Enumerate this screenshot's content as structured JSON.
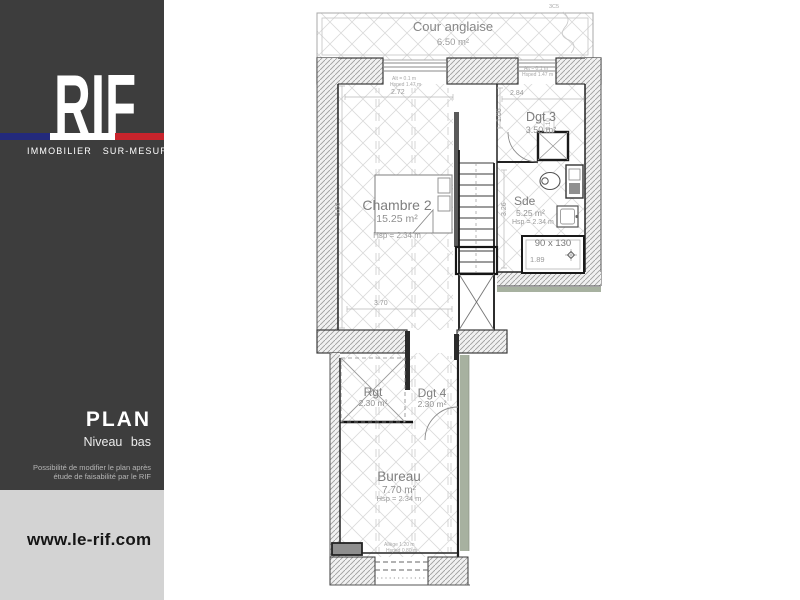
{
  "sidebar": {
    "logo": "RIF",
    "tagline": "IMMOBILIER SUR-MESURE",
    "plan_title": "PLAN",
    "plan_subtitle": "Niveau bas",
    "note_line1": "Possibilité de modifier le plan après",
    "note_line2": "étude de faisabilité par le RIF",
    "website": "www.le-rif.com",
    "colors": {
      "background": "#3d3d3d",
      "footer_bg": "#d3d3d3",
      "flag_blue": "#232a7c",
      "flag_white": "#ffffff",
      "flag_red": "#c8242c"
    }
  },
  "plan": {
    "rooms": {
      "cour": {
        "name": "Cour anglaise",
        "area": "6.50 m²"
      },
      "dgt3": {
        "name": "Dgt 3",
        "area": "3.50 m²"
      },
      "chambre2": {
        "name": "Chambre 2",
        "area": "15.25 m²",
        "height": "Hsp = 2.34 m"
      },
      "sde": {
        "name": "Sde",
        "area": "5.25 m²",
        "height": "Hsp = 2.34 m"
      },
      "rgt": {
        "name": "Rgt",
        "area": "2.30 m²"
      },
      "dgt4": {
        "name": "Dgt 4",
        "area": "2.30 m²"
      },
      "bureau": {
        "name": "Bureau",
        "area": "7.70 m²",
        "height": "Hsp = 2.34 m"
      }
    },
    "fixtures": {
      "shower_size": "90 x 130",
      "shower_depth": "1.89"
    },
    "dims": {
      "w272": "2.72",
      "w284": "2.84",
      "w370": "3.70",
      "h566": "5.66",
      "h106": "1.06",
      "h326": "3.26",
      "h010": "0.10"
    },
    "notes": {
      "win_top1_l1": "Alt = 0.1 m",
      "win_top1_l2": "Hsped 1.47 m",
      "win_top2_l1": "Alt = 0.1 m",
      "win_top2_l2": "Hsped 1.47 m",
      "win_bottom_l1": "Allège 1.20 m",
      "win_bottom_l2": "Hsped 0.80 m"
    },
    "annotation_top_right": "3C5",
    "colors": {
      "wall_line": "#1a1a1a",
      "insulation_green": "#a7b1a0",
      "hatch": "#dadada"
    }
  }
}
